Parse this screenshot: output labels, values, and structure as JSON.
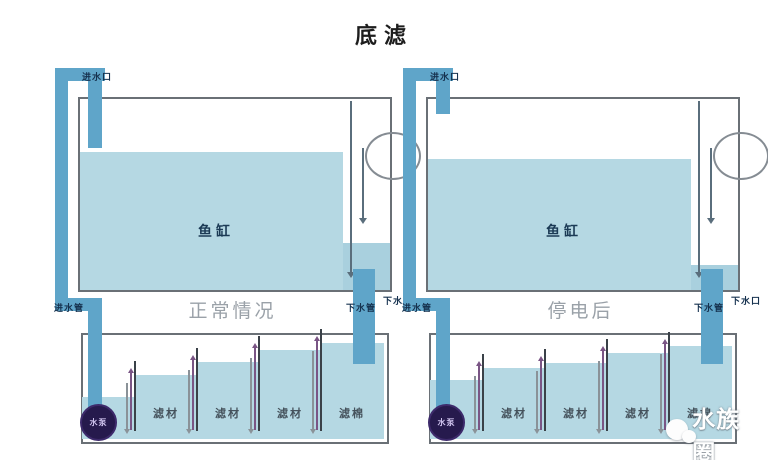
{
  "title": "底滤",
  "watermark": {
    "text": "水族圈"
  },
  "colors": {
    "water": "#b5d8e3",
    "pipe": "#5fa5c9",
    "pump_circle": "#261a4d",
    "caption_gray": "#9aa1a8",
    "label_navy": "#16324f"
  },
  "diagrams": [
    {
      "id": "normal",
      "caption": "正常情况",
      "labels": {
        "tank": "鱼缸",
        "inlet_port": "进水口",
        "drain_port": "下水口",
        "inlet_pipe": "进水管",
        "drain_pipe": "下水管",
        "pump": "水泵"
      },
      "sump_chambers": [
        "滤材",
        "滤材",
        "滤材",
        "滤棉"
      ]
    },
    {
      "id": "power-off",
      "caption": "停电后",
      "labels": {
        "tank": "鱼缸",
        "inlet_port": "进水口",
        "drain_port": "下水口",
        "inlet_pipe": "进水管",
        "drain_pipe": "下水管",
        "pump": "水泵"
      },
      "sump_chambers": [
        "滤材",
        "滤材",
        "滤材",
        "滤棉"
      ]
    }
  ]
}
